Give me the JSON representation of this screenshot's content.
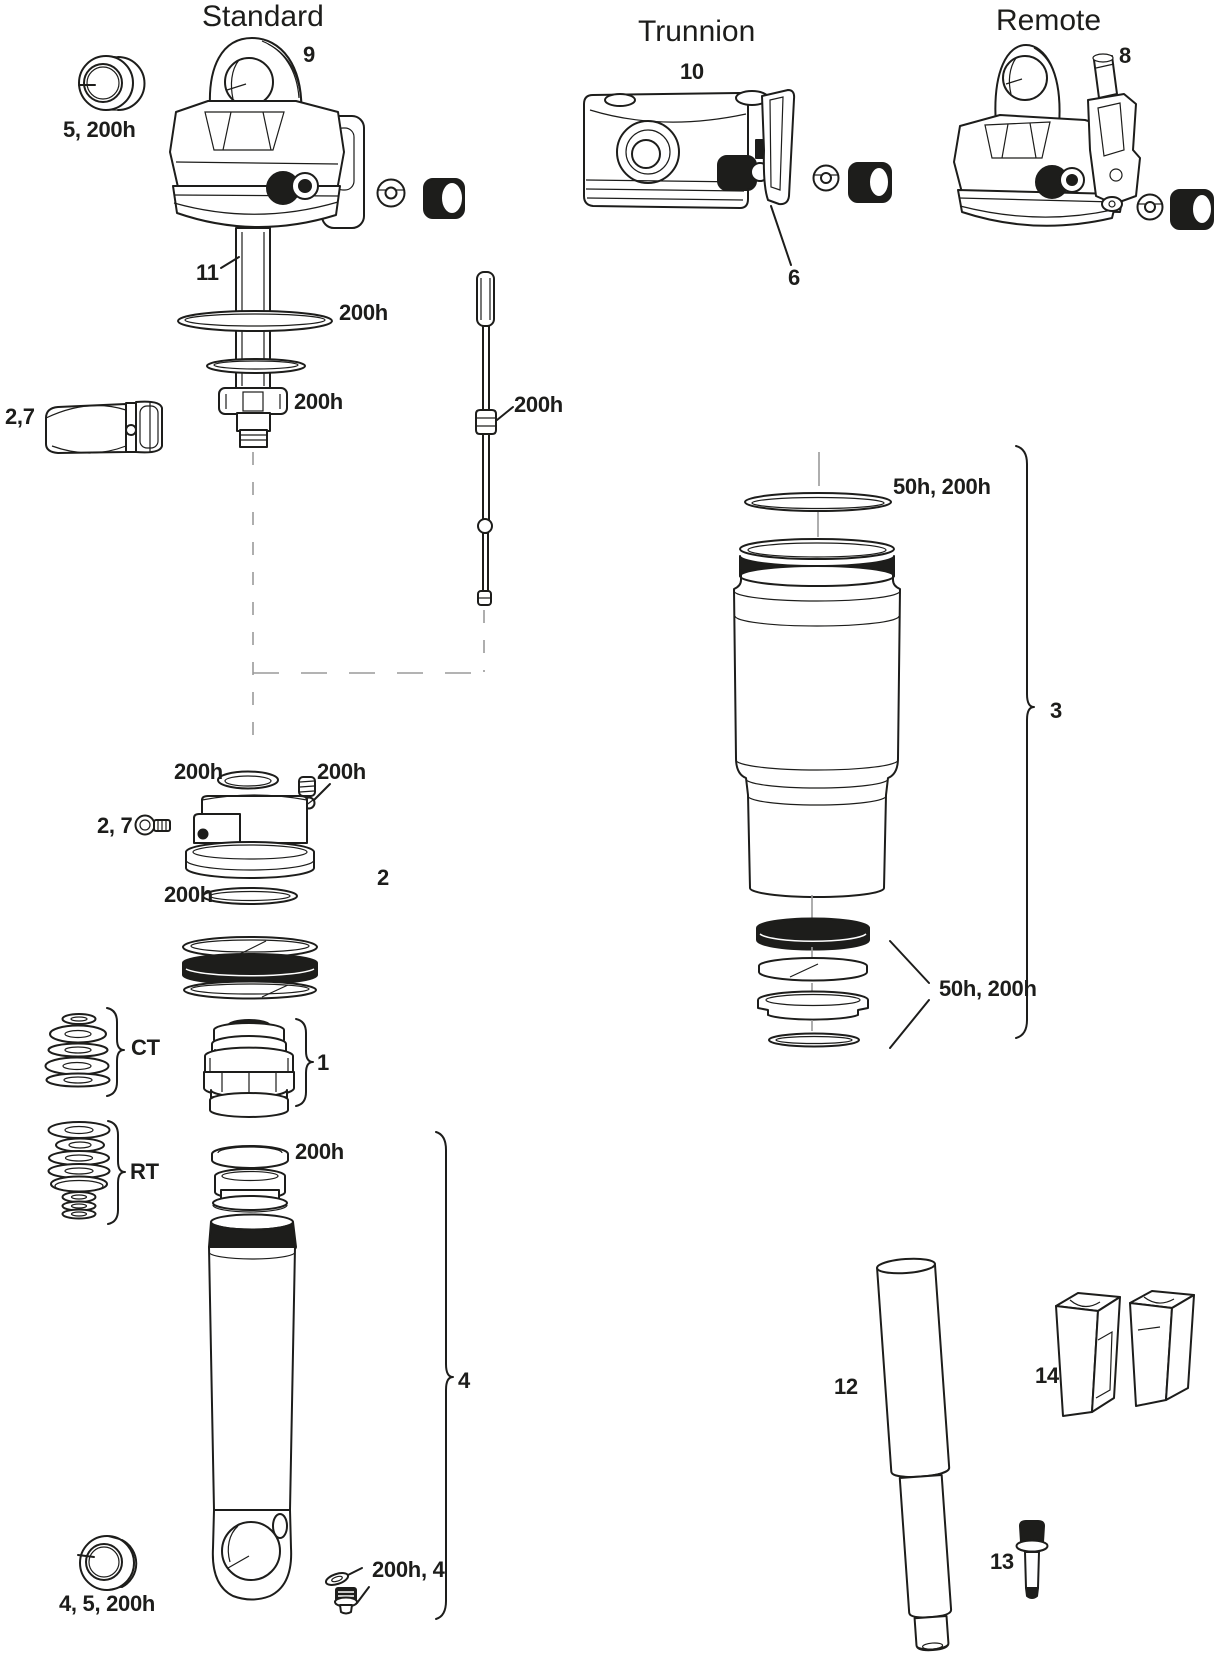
{
  "page": {
    "background": "#ffffff",
    "ink_color": "#1d1d1b",
    "guide_color": "#9a9a9a"
  },
  "sections": {
    "standard": "Standard",
    "trunnion": "Trunnion",
    "remote": "Remote"
  },
  "labels": {
    "part_9": "9",
    "part_10": "10",
    "part_8": "8",
    "part_6": "6",
    "part_11": "11",
    "part_1": "1",
    "part_2": "2",
    "part_3": "3",
    "part_4": "4",
    "part_12": "12",
    "part_13": "13",
    "part_14": "14",
    "standard_bushing": "5, 200h",
    "shaft_clamp": "2,7",
    "shaft_ring_service": "200h",
    "shaft_end_service": "200h",
    "reservoir_rod_service": "200h",
    "air_can_top_seal": "50h, 200h",
    "air_can_bottom_seals": "50h, 200h",
    "piston_top_seal": "200h",
    "piston_set_screw": "200h",
    "piston_bolt": "2, 7",
    "piston_lower_seal": "200h",
    "ct_shims": "CT",
    "rt_shims": "RT",
    "seal_head_service": "200h",
    "body_bleed": "200h, 4",
    "body_bushing": "4, 5, 200h"
  }
}
